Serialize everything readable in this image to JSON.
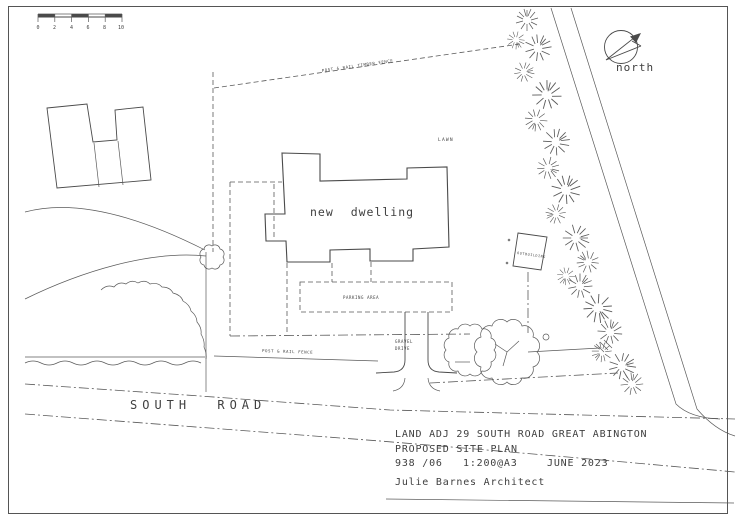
{
  "colors": {
    "ink": "#4a4a4a",
    "paper": "#ffffff"
  },
  "scale_bar": {
    "ticks": [
      "0",
      "2",
      "4",
      "6",
      "8",
      "10"
    ]
  },
  "north": {
    "label": "north"
  },
  "plan": {
    "dwelling_label": "new dwelling",
    "lawn_label": "LAWN",
    "parking_label": "PARKING AREA",
    "outbuilding_label": "OUTBUILDING",
    "fence_top_label": "POST & RAIL TIMBER FENCE",
    "fence_bottom_label": "POST & RAIL FENCE",
    "drive_label_line1": "GRAVEL",
    "drive_label_line2": "DRIVE",
    "road_label": "SOUTH ROAD"
  },
  "title_block": {
    "project": "LAND ADJ 29 SOUTH ROAD  GREAT ABINGTON",
    "drawing": "PROPOSED SITE PLAN",
    "job_number": "938 /06",
    "scale": "1:200@A3",
    "date": "JUNE 2023",
    "architect": "Julie Barnes Architect"
  }
}
